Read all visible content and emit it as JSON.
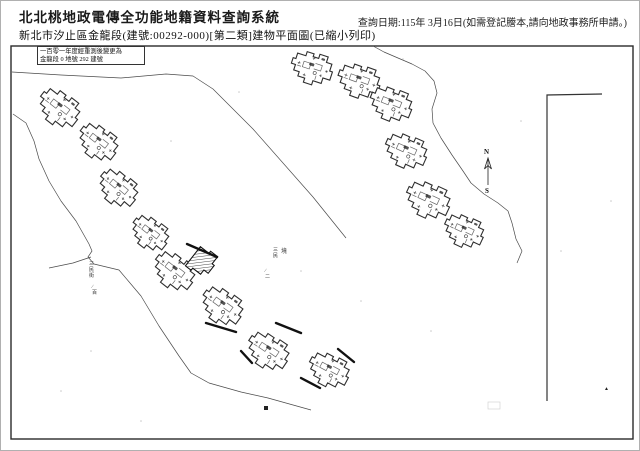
{
  "header": {
    "system_title": "北北桃地政電傳全功能地籍資料查詢系統",
    "query_date": "查詢日期:115年 3月16日(如需登記謄本,請向地政事務所申請。)",
    "subtitle": "新北市汐止區金龍段(建號:00292-000)[第二類]建物平面圖(已縮小列印)"
  },
  "map": {
    "note_box": {
      "line1": "一百零一年度經重測後變更為",
      "line2": "金龍段 0 地號 292 建號"
    },
    "compass": {
      "north": "N",
      "south": "S",
      "x": 487,
      "y_top": 157,
      "y_bottom": 184
    },
    "frame": {
      "x": 10,
      "y": 45,
      "w": 622,
      "h": 393
    },
    "boundary_line": "601,93 546,94 546,400",
    "contours": [
      "11,71 60,74 120,77 165,73 192,75 212,88 252,128 312,196 345,237",
      "12,113 25,122 33,140 38,158 48,180 60,200 75,220 88,243 91,250 87,256 93,263 118,269 140,295 158,325 178,355 190,372 208,382 240,391 267,397 310,409",
      "48,267 72,262 90,256",
      "372,45 383,51 397,57 411,63 424,70 433,80 436,92 431,108 432,122 440,137 451,154 462,170 470,182 483,193 497,202 507,210 511,222 515,238 521,250 516,262"
    ],
    "clusters": [
      {
        "x": 57,
        "y": 107,
        "r": 38,
        "s": 0.75
      },
      {
        "x": 96,
        "y": 141,
        "r": 38,
        "s": 0.72
      },
      {
        "x": 116,
        "y": 187,
        "r": 40,
        "s": 0.72
      },
      {
        "x": 148,
        "y": 232,
        "r": 38,
        "s": 0.68
      },
      {
        "x": 172,
        "y": 270,
        "r": 38,
        "s": 0.75
      },
      {
        "x": 220,
        "y": 305,
        "r": 36,
        "s": 0.75
      },
      {
        "x": 266,
        "y": 350,
        "r": 34,
        "s": 0.75
      },
      {
        "x": 327,
        "y": 369,
        "r": 28,
        "s": 0.72
      },
      {
        "x": 310,
        "y": 67,
        "r": 18,
        "s": 0.72
      },
      {
        "x": 357,
        "y": 80,
        "r": 20,
        "s": 0.74
      },
      {
        "x": 389,
        "y": 103,
        "r": 22,
        "s": 0.74
      },
      {
        "x": 404,
        "y": 150,
        "r": 24,
        "s": 0.74
      },
      {
        "x": 426,
        "y": 199,
        "r": 25,
        "s": 0.78
      },
      {
        "x": 462,
        "y": 230,
        "r": 25,
        "s": 0.7
      }
    ],
    "subject_building": {
      "x": 200,
      "y": 261,
      "r": 38,
      "s": 0.9
    },
    "walls": [
      [
        186,
        243,
        216,
        256
      ],
      [
        205,
        322,
        235,
        331
      ],
      [
        275,
        322,
        300,
        332
      ],
      [
        240,
        350,
        251,
        362
      ],
      [
        337,
        348,
        353,
        361
      ],
      [
        300,
        377,
        319,
        387
      ]
    ],
    "labels": [
      {
        "text": "三民街",
        "x": 88,
        "y": 264,
        "vertical": true,
        "fs": 5
      },
      {
        "text": "∕百",
        "x": 91,
        "y": 287,
        "vertical": true,
        "fs": 5
      },
      {
        "text": "三民",
        "x": 272,
        "y": 250,
        "vertical": true,
        "fs": 5
      },
      {
        "text": "∕二",
        "x": 264,
        "y": 271,
        "vertical": true,
        "fs": 5
      },
      {
        "text": "境",
        "x": 280,
        "y": 252,
        "vertical": false,
        "fs": 6
      }
    ],
    "marks": {
      "black_square": {
        "x": 263,
        "y": 405,
        "w": 4,
        "h": 4
      },
      "dark_triangle": {
        "x": 603,
        "y": 389,
        "glyph": "▲"
      },
      "faint_box": {
        "x": 487,
        "y": 401,
        "w": 12,
        "h": 7
      }
    },
    "specks": [
      [
        238,
        91
      ],
      [
        300,
        270
      ],
      [
        170,
        140
      ],
      [
        520,
        120
      ],
      [
        560,
        250
      ],
      [
        430,
        330
      ],
      [
        90,
        350
      ],
      [
        60,
        390
      ],
      [
        360,
        300
      ],
      [
        610,
        200
      ],
      [
        402,
        58
      ],
      [
        140,
        420
      ]
    ]
  },
  "colors": {
    "ink": "#1a1a1a",
    "map_line": "#4a4a4a",
    "building_stroke": "#2e2e2e",
    "wall": "#111111",
    "hatch": "#333333",
    "noise": "#c9c9c9"
  }
}
